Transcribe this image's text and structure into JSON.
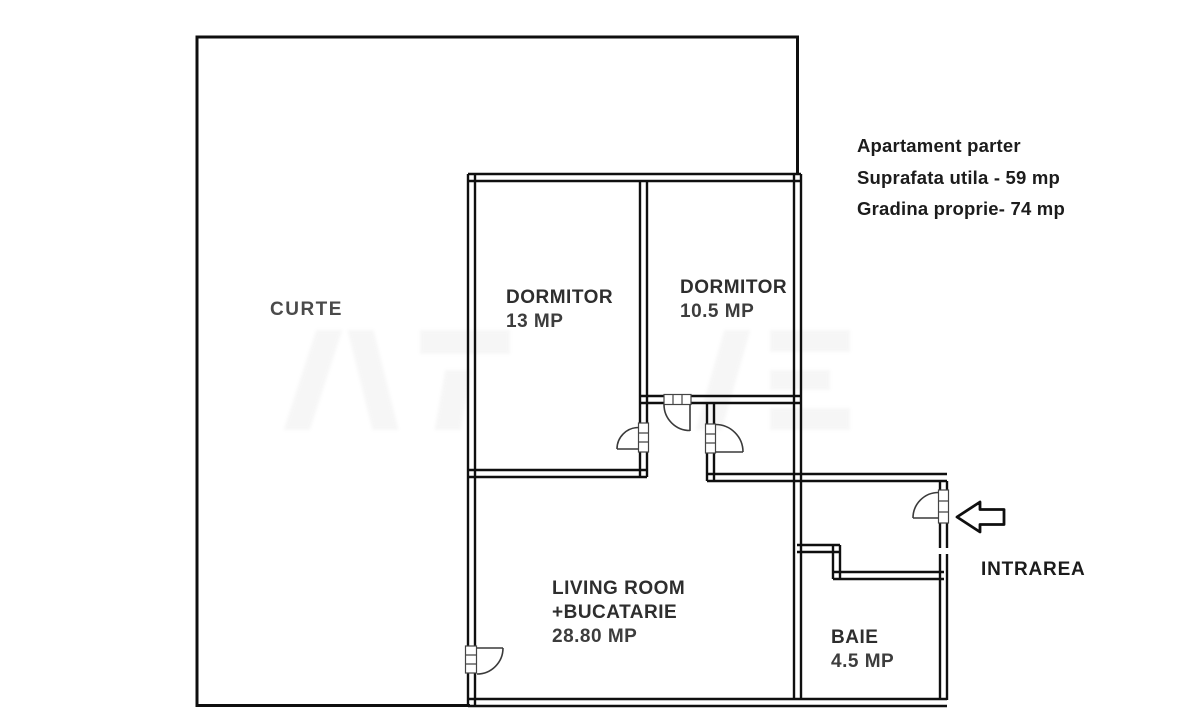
{
  "info_block": {
    "line1": "Apartament parter",
    "line2": "Suprafata utila - 59 mp",
    "line3": "Gradina proprie- 74 mp"
  },
  "rooms": {
    "curte": {
      "name": "CURTE"
    },
    "dormitor1": {
      "name": "DORMITOR",
      "area": "13 MP"
    },
    "dormitor2": {
      "name": "DORMITOR",
      "area": "10.5 MP"
    },
    "living": {
      "name": "LIVING ROOM",
      "name2": "+BUCATARIE",
      "area": "28.80 MP"
    },
    "baie": {
      "name": "BAIE",
      "area": "4.5 MP"
    }
  },
  "entrance": {
    "label": "INTRAREA"
  },
  "colors": {
    "wall": "#0f0f0f",
    "door": "#3a3a3a",
    "text": "#1c1c1c",
    "background": "#ffffff"
  }
}
